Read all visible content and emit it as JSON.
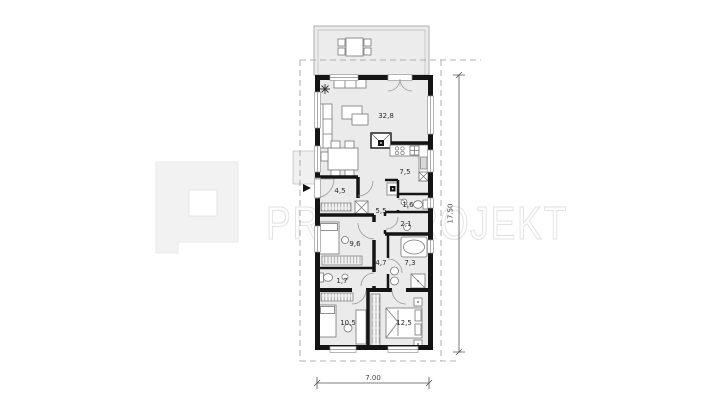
{
  "watermark": {
    "text": "PROMPROJEKT",
    "logo_name": "promprojekt-p-logo",
    "color": "#e2e2e2"
  },
  "plan": {
    "rooms": [
      {
        "id": "living-room",
        "area": "32,8"
      },
      {
        "id": "kitchen",
        "area": "7,5"
      },
      {
        "id": "entry-hall",
        "area": "4,5"
      },
      {
        "id": "corridor",
        "area": "5,5"
      },
      {
        "id": "wc",
        "area": "1,6"
      },
      {
        "id": "pantry",
        "area": "2,1"
      },
      {
        "id": "bedroom-small",
        "area": "9,6"
      },
      {
        "id": "hallway",
        "area": "4,7"
      },
      {
        "id": "bathroom",
        "area": "7,3"
      },
      {
        "id": "toilet",
        "area": "1,7"
      },
      {
        "id": "bedroom-left",
        "area": "10,5"
      },
      {
        "id": "bedroom-main",
        "area": "12,5"
      }
    ],
    "dimensions": {
      "total_width": "7.00",
      "total_height": "17.50"
    },
    "colors": {
      "wall": "#141414",
      "floor": "#ebebeb",
      "terrace": "#ececec",
      "dashed_boundary": "#9a9a9a",
      "dimension_line": "#555555"
    }
  }
}
